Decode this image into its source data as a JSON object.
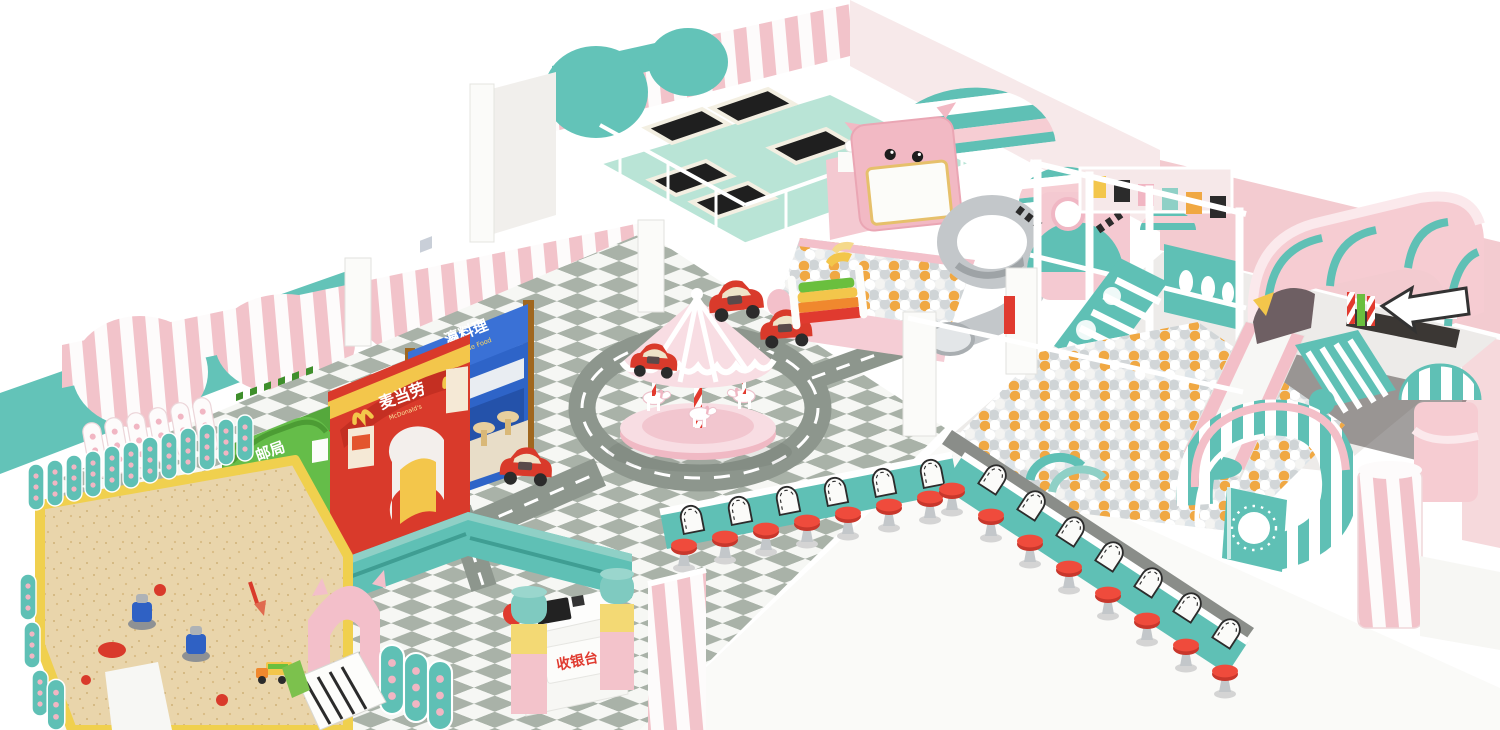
{
  "scene": {
    "subject": "pastel indoor kids playground 3D render",
    "background": "#ffffff"
  },
  "palette": {
    "teal": "#63c3b8",
    "teal_dark": "#48b2a6",
    "mint_floor": "#b9e4d6",
    "pink": "#f3c3cb",
    "pink_light": "#f8dde1",
    "checker_gray": "#a9b2a8",
    "road_gray": "#8d968d",
    "red": "#e03a2f",
    "yellow": "#f3c64b",
    "sand": "#e9d5ab",
    "green_building": "#65bd49",
    "blue_building": "#2e64c8",
    "ball_orange": "#f0a843",
    "trampoline_black": "#1f1f1f",
    "slide_gray": "#c3c7ca"
  },
  "labels": {
    "post_office": {
      "cn": "邮局",
      "en": "POST OFFICE"
    },
    "mcdonalds": {
      "cn": "麦当劳",
      "en": "McDonald's"
    },
    "japanese_food": {
      "cn": "瀛料理",
      "en": "Japanese Food"
    },
    "cashier": {
      "cn": "收银台"
    }
  },
  "zones": [
    "sand-pit",
    "role-play-street",
    "carousel",
    "road-circuit",
    "trampoline-area",
    "interactive-projection-screen",
    "toddler-ball-pit",
    "spiral-tube-slide",
    "climbing-frame",
    "big-ball-pool",
    "wide-slide",
    "pink-tunnel",
    "curved-pool-wall",
    "diner-counters",
    "cashier-desk",
    "storage-shelves"
  ]
}
